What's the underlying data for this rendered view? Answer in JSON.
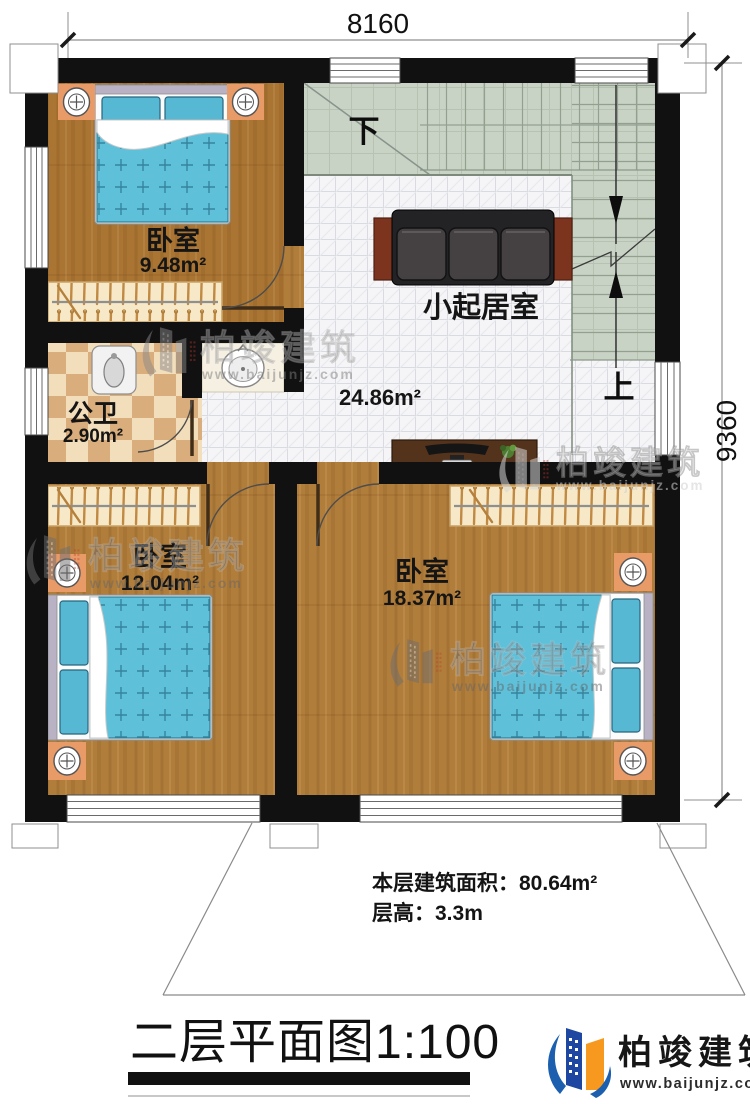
{
  "plan": {
    "dimensions": {
      "width": "8160",
      "depth": "9360"
    },
    "stairs": {
      "down": "下",
      "up": "上"
    },
    "rooms": {
      "bedroom_top": {
        "name": "卧室",
        "area": "9.48m²"
      },
      "bathroom": {
        "name": "公卫",
        "area": "2.90m²"
      },
      "living": {
        "name": "小起居室",
        "area": "24.86m²"
      },
      "bedroom_left": {
        "name": "卧室",
        "area": "12.04m²"
      },
      "bedroom_right": {
        "name": "卧室",
        "area": "18.37m²"
      }
    }
  },
  "notes": {
    "floor_area": "本层建筑面积：80.64m²",
    "floor_height": "层高：3.3m"
  },
  "title": {
    "text": "二层平面图1:100"
  },
  "brand": {
    "name": "柏竣建筑",
    "website": "www.baijunjz.com"
  },
  "colors": {
    "wall": "#111111",
    "wood_floor": "#b17d3a",
    "bed_blue": "#5fc0da",
    "stair_green": "#c9d3c5",
    "bath_tile_tan": "#d9ae7c",
    "sofa_dark": "#232325",
    "logo_blue": "#1b5fae",
    "logo_orange": "#f6991e"
  }
}
